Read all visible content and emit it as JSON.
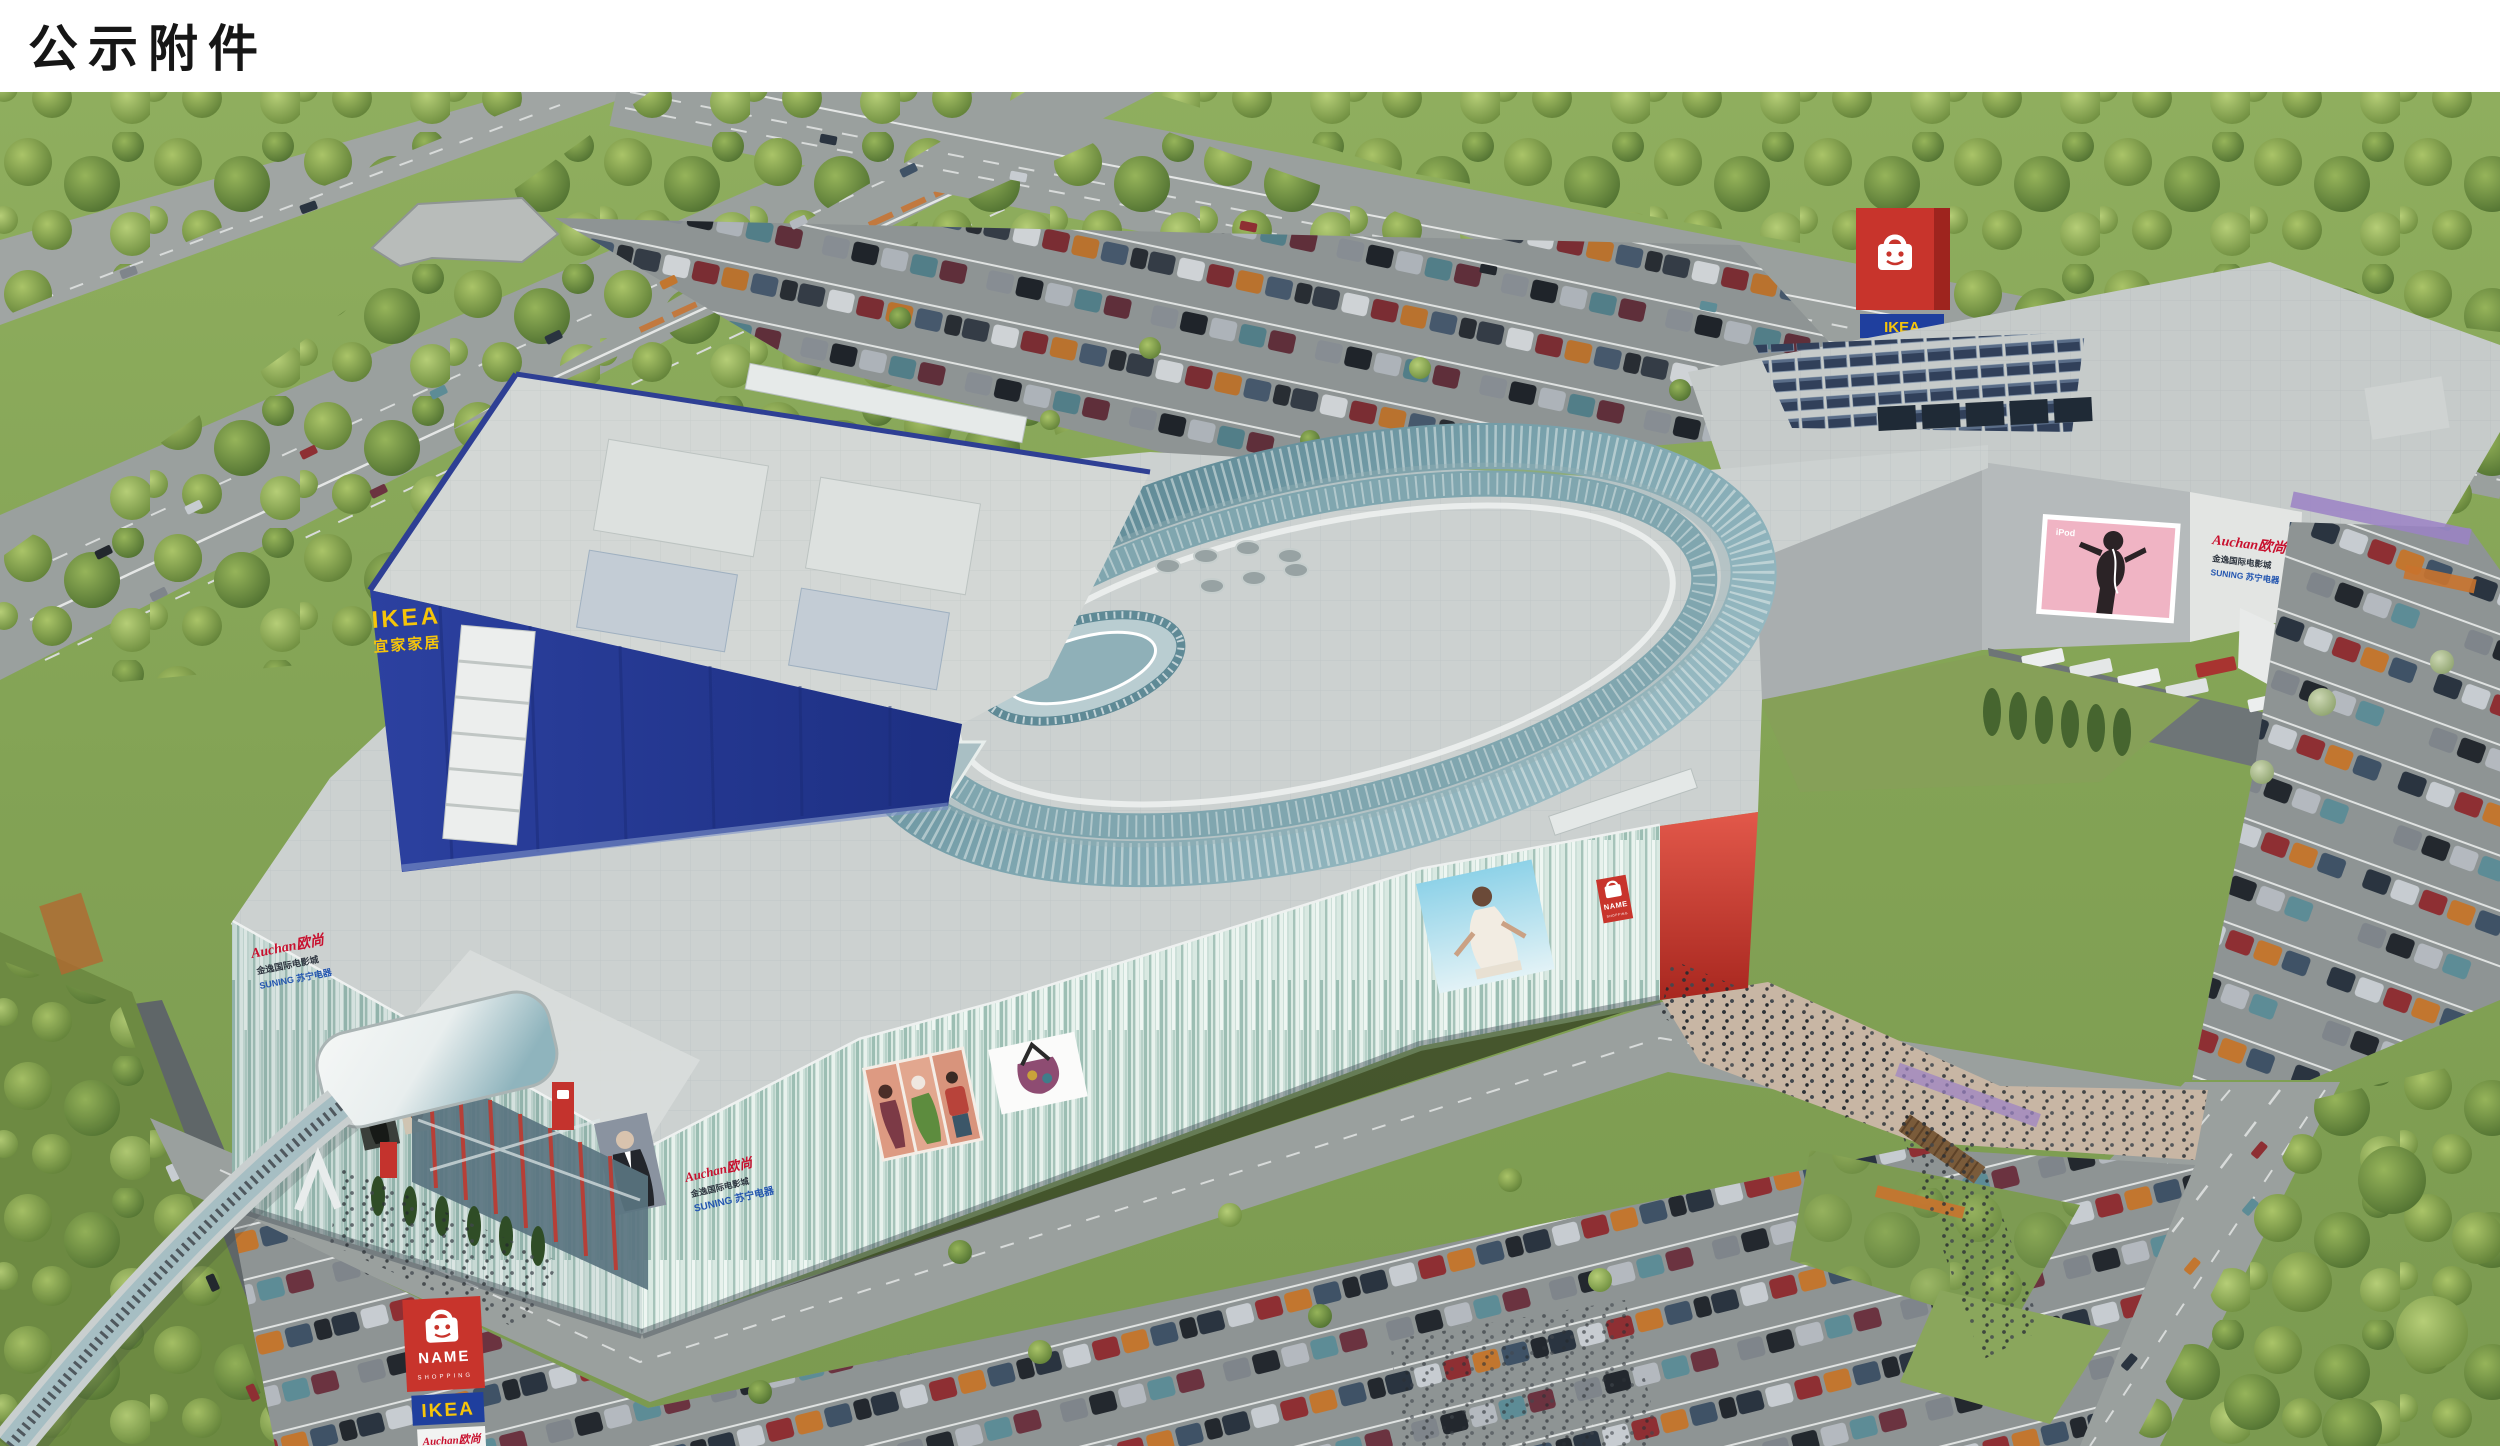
{
  "page": {
    "title": "公示附件"
  },
  "ikea_store": {
    "sign_en": "IKEA",
    "sign_cn": "宜家家居"
  },
  "mall_logo": {
    "name": "NAME",
    "subtitle": "SHOPPING"
  },
  "tenants": {
    "auchan": "Auchan欧尚",
    "cinema": "金逸国际电影城",
    "suning": "SUNING 苏宁电器"
  },
  "pylon_top": {
    "ikea": "IKEA",
    "auchan": "Auchan欧尚",
    "cinema": "金逸国际电影城",
    "suning": "苏宁电器"
  },
  "pylon_bottom": {
    "name": "NAME",
    "subtitle": "SHOPPING",
    "ikea": "IKEA",
    "auchan": "Auchan欧尚",
    "cinema": "金逸国际电影城"
  },
  "billboards": {
    "ipod": "iPod"
  },
  "colors": {
    "ikea_blue": "#24399b",
    "ikea_yellow": "#f6c50a",
    "mall_red": "#c8342c",
    "mint": "#cde0d9",
    "roof_teal": "#5f8a96",
    "billboard_pink": "#f0b4c4",
    "auchan_red": "#c8102e",
    "suning_blue": "#2456b0",
    "cinema_dark": "#2f3640"
  }
}
